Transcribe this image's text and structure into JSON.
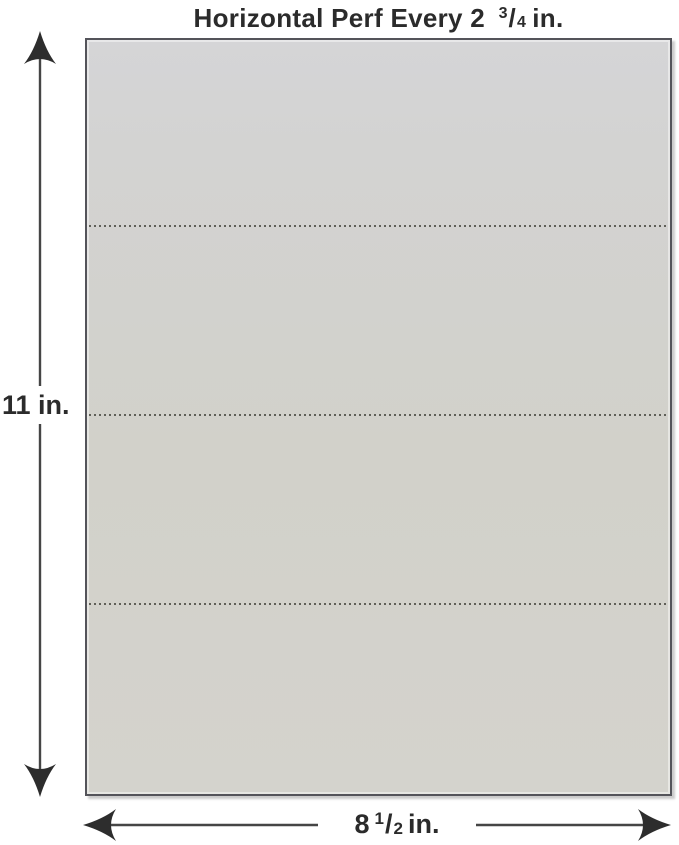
{
  "title": {
    "prefix": "Horizontal Perf Every 2",
    "fraction": {
      "numerator": "3",
      "slash": "/",
      "denominator": "4"
    },
    "suffix": "in."
  },
  "dimensions": {
    "height_label": "11 in.",
    "width": {
      "prefix": "8",
      "fraction": {
        "numerator": "1",
        "slash": "/",
        "denominator": "2"
      },
      "suffix": "in."
    }
  },
  "sheet": {
    "perforation_positions_pct": [
      24.5,
      49.6,
      74.7
    ]
  },
  "icons": {
    "arrow_up": "arrow-up-icon",
    "arrow_down": "arrow-down-icon",
    "arrow_left": "arrow-left-icon",
    "arrow_right": "arrow-right-icon"
  },
  "colors": {
    "background": "#ffffff",
    "sheet_fill_top": "#d5d5d7",
    "sheet_fill_bottom": "#d4d3cd",
    "sheet_border": "#54545a",
    "arrow": "#454545",
    "arrow_head": "#2d2d2d",
    "perf": "#4b4b44",
    "text": "#2b2b2b"
  }
}
